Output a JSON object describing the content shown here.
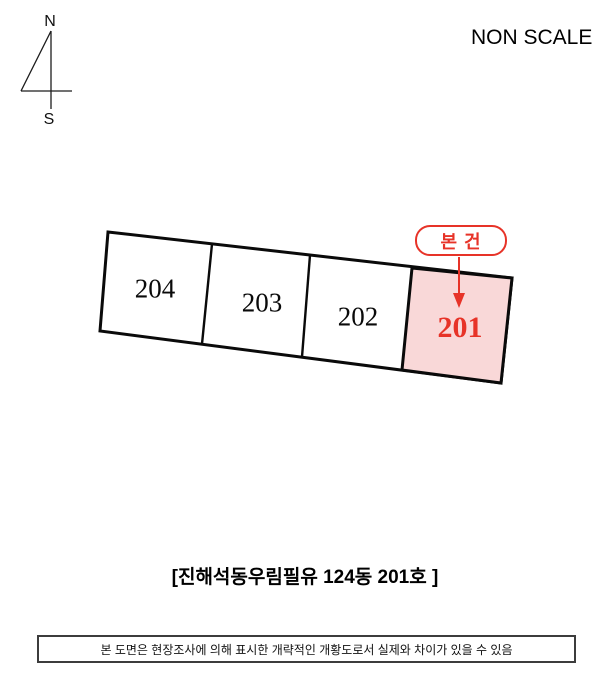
{
  "scale_note": "NON SCALE",
  "compass": {
    "north": "N",
    "south": "S"
  },
  "diagram": {
    "badge_label": "본 건",
    "parcels": [
      {
        "label": "204",
        "highlighted": false
      },
      {
        "label": "203",
        "highlighted": false
      },
      {
        "label": "202",
        "highlighted": false
      },
      {
        "label": "201",
        "highlighted": true
      }
    ],
    "colors": {
      "highlight_fill": "#f9d8d8",
      "accent_red": "#e73328",
      "outline_black": "#0a0a0a"
    }
  },
  "caption": "[진해석동우림필유 124동 201호 ]",
  "footer_note": "본 도면은 현장조사에 의해 표시한 개략적인 개황도로서 실제와 차이가 있을 수 있음"
}
